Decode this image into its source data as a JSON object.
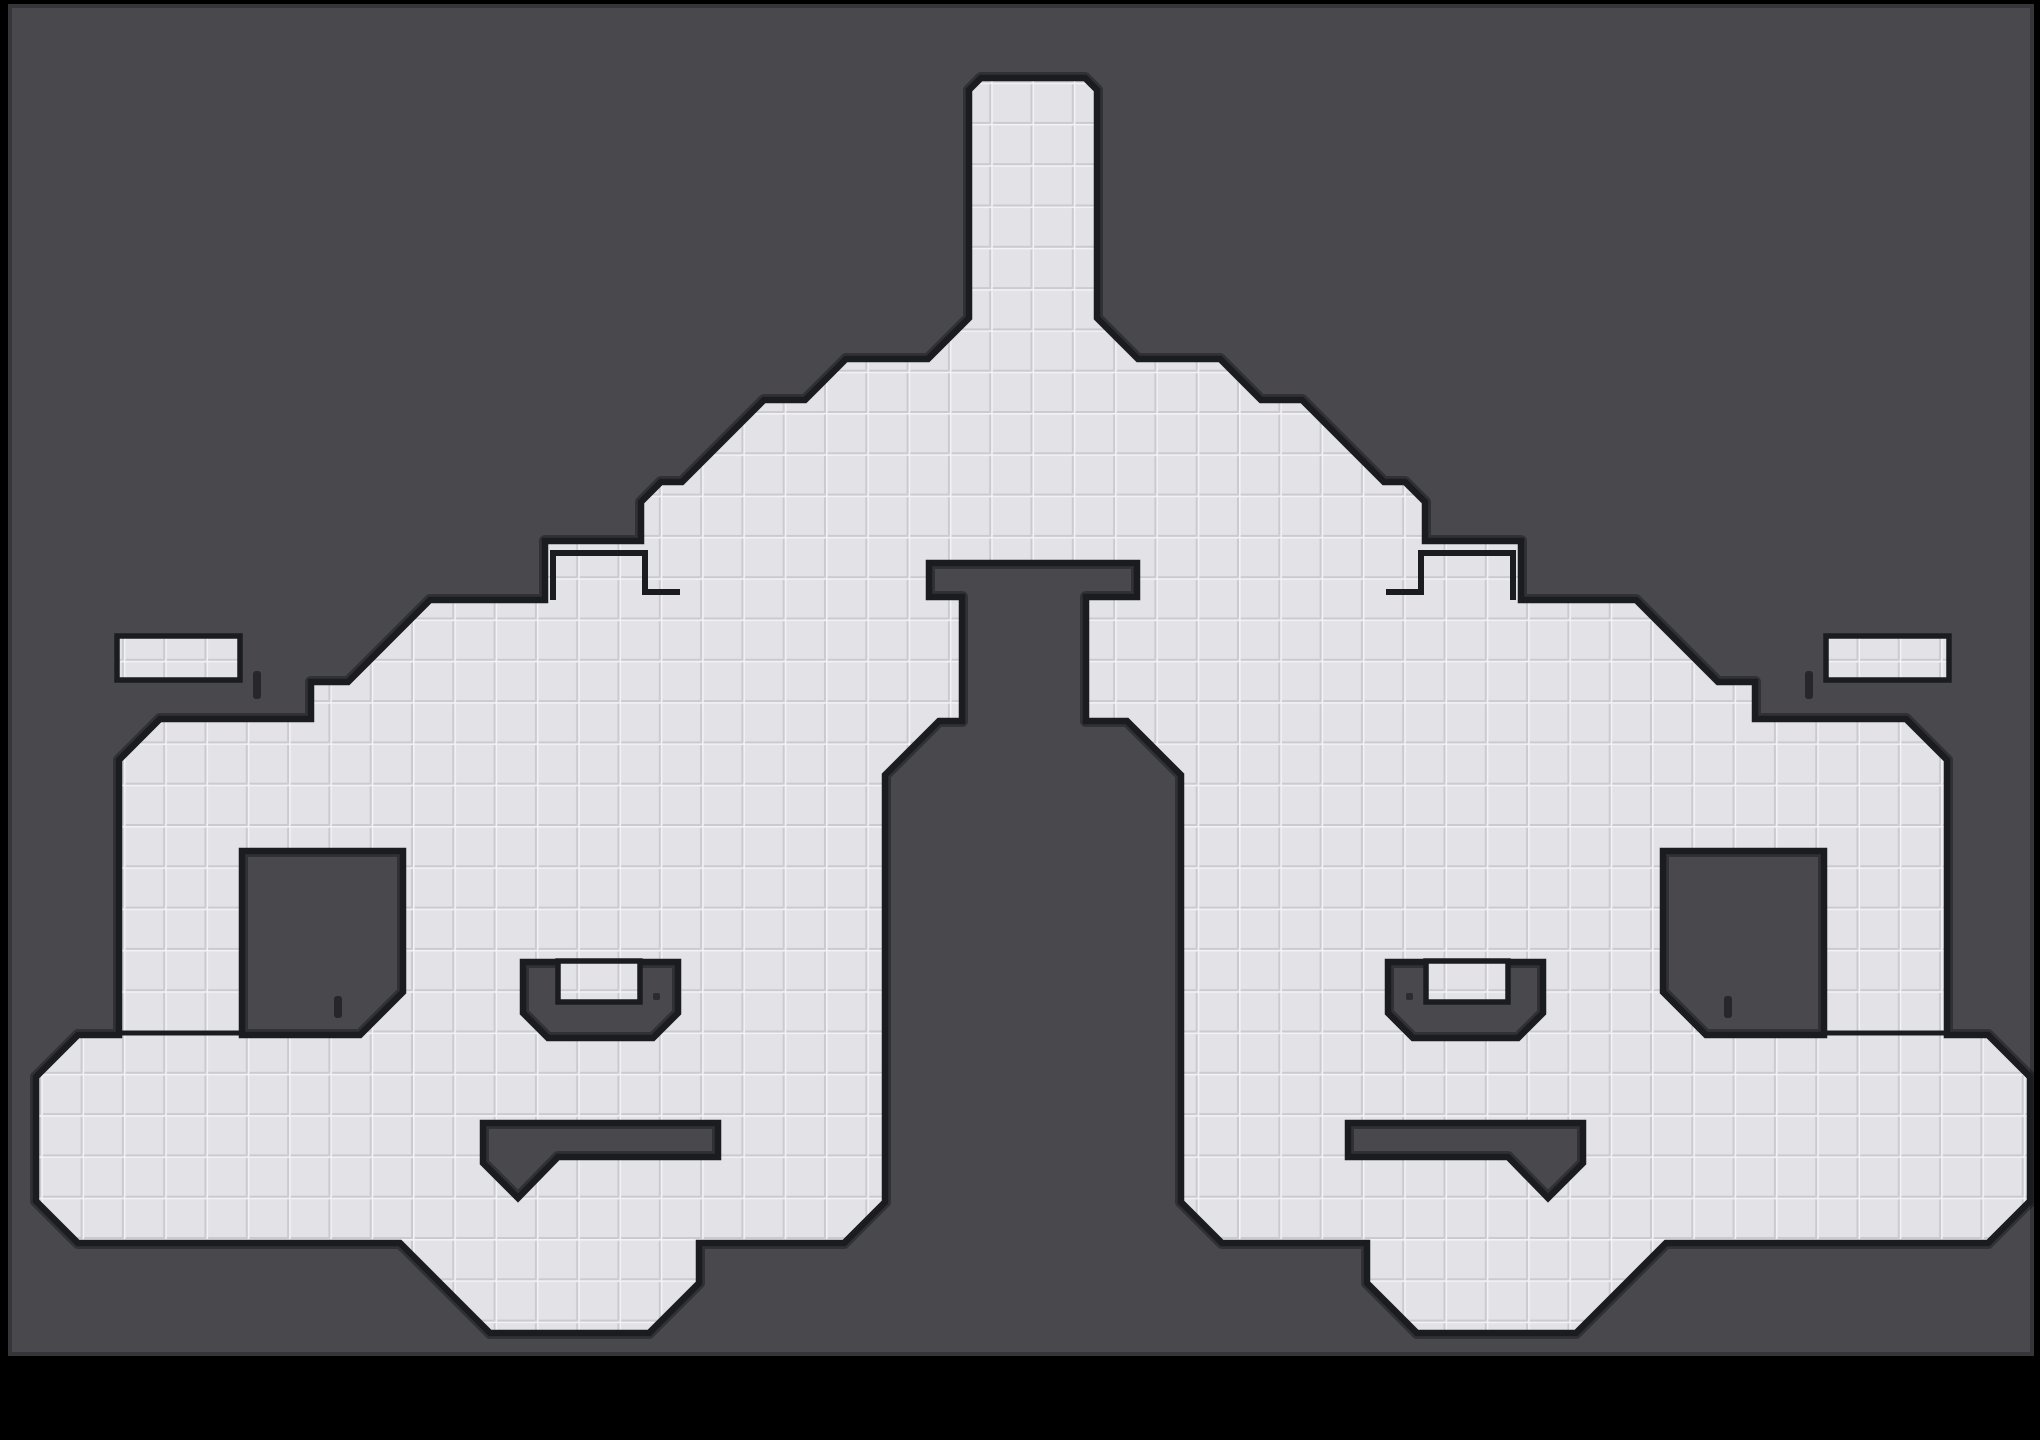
{
  "scene": {
    "kind": "tile-platformer-level-map",
    "canvas": {
      "w": 2040,
      "h": 1440
    },
    "field": {
      "x": 10,
      "y": 6,
      "w": 2022,
      "h": 1348
    }
  },
  "palette": {
    "page_bg": "#000000",
    "field_bg": "#49494d",
    "field_border": "#35353a",
    "tile": "#e3e3e7",
    "tile_line": "#cbcbcf",
    "tile_highlight": "#f2f2f6",
    "outline": "#1b1c20",
    "gold": "#f6c41c",
    "bomb_purple": "#bb7fb6",
    "green_block": "#9ed45e",
    "dotted_block": "#a0a0a4",
    "cross_orange": "#e85f2e",
    "cross_yellow": "#eda211",
    "cross_teal": "#45a89e",
    "flag_red": "#e8402e",
    "flag_red_tip": "#f5a02c",
    "flag_teal": "#4fa8cc",
    "flag_teal_tip": "#6ec98e",
    "gear": "#1a1a1a",
    "orb_green": "#8fce62"
  },
  "geometry": {
    "tile_size": 41.3,
    "outline": [
      [
        981,
        78
      ],
      [
        1085,
        78
      ],
      [
        1097,
        90
      ],
      [
        1097,
        318
      ],
      [
        1138,
        359
      ],
      [
        1220,
        359
      ],
      [
        1261,
        400
      ],
      [
        1302,
        400
      ],
      [
        1384,
        482
      ],
      [
        1405,
        482
      ],
      [
        1425,
        502
      ],
      [
        1425,
        541
      ],
      [
        1521,
        541
      ],
      [
        1521,
        600
      ],
      [
        1636,
        600
      ],
      [
        1718,
        682
      ],
      [
        1755,
        682
      ],
      [
        1755,
        719
      ],
      [
        1906,
        719
      ],
      [
        1947,
        760
      ],
      [
        1947,
        1035
      ],
      [
        1988,
        1035
      ],
      [
        2030,
        1077
      ],
      [
        2030,
        1201
      ],
      [
        1988,
        1243
      ],
      [
        1666,
        1243
      ],
      [
        1626,
        1283
      ],
      [
        1576,
        1333
      ],
      [
        1417,
        1333
      ],
      [
        1367,
        1283
      ],
      [
        1367,
        1243
      ],
      [
        1222,
        1243
      ],
      [
        1181,
        1202
      ],
      [
        1181,
        775
      ],
      [
        1127,
        721
      ],
      [
        1086,
        721
      ],
      [
        1086,
        597
      ],
      [
        1137,
        597
      ],
      [
        1137,
        563
      ],
      [
        929,
        563
      ],
      [
        929,
        597
      ],
      [
        962,
        597
      ],
      [
        962,
        721
      ],
      [
        939,
        721
      ],
      [
        885,
        775
      ],
      [
        885,
        1202
      ],
      [
        844,
        1243
      ],
      [
        699,
        1243
      ],
      [
        699,
        1283
      ],
      [
        649,
        1333
      ],
      [
        490,
        1333
      ],
      [
        440,
        1283
      ],
      [
        400,
        1243
      ],
      [
        78,
        1243
      ],
      [
        36,
        1201
      ],
      [
        36,
        1077
      ],
      [
        78,
        1035
      ],
      [
        119,
        1035
      ],
      [
        119,
        760
      ],
      [
        160,
        719
      ],
      [
        311,
        719
      ],
      [
        311,
        682
      ],
      [
        348,
        682
      ],
      [
        430,
        600
      ],
      [
        545,
        600
      ],
      [
        545,
        541
      ],
      [
        641,
        541
      ],
      [
        641,
        502
      ],
      [
        661,
        482
      ],
      [
        682,
        482
      ],
      [
        764,
        400
      ],
      [
        805,
        400
      ],
      [
        846,
        359
      ],
      [
        928,
        359
      ],
      [
        969,
        318
      ],
      [
        969,
        90
      ]
    ],
    "holes": [
      [
        [
          242,
          851
        ],
        [
          403,
          851
        ],
        [
          403,
          992
        ],
        [
          360,
          1035
        ],
        [
          242,
          1035
        ]
      ],
      [
        [
          1663,
          851
        ],
        [
          1824,
          851
        ],
        [
          1824,
          1035
        ],
        [
          1706,
          1035
        ],
        [
          1663,
          992
        ]
      ],
      [
        [
          523,
          962
        ],
        [
          678,
          962
        ],
        [
          678,
          1013
        ],
        [
          653,
          1038
        ],
        [
          548,
          1038
        ],
        [
          523,
          1013
        ]
      ],
      [
        [
          1388,
          962
        ],
        [
          1543,
          962
        ],
        [
          1543,
          1013
        ],
        [
          1518,
          1038
        ],
        [
          1413,
          1038
        ],
        [
          1388,
          1013
        ]
      ],
      [
        [
          483,
          1123
        ],
        [
          718,
          1123
        ],
        [
          718,
          1157
        ],
        [
          558,
          1157
        ],
        [
          518,
          1198
        ],
        [
          483,
          1163
        ]
      ],
      [
        [
          1348,
          1123
        ],
        [
          1583,
          1123
        ],
        [
          1583,
          1163
        ],
        [
          1548,
          1198
        ],
        [
          1508,
          1157
        ],
        [
          1348,
          1157
        ]
      ]
    ],
    "notch_lines": [
      [
        [
          553,
          600
        ],
        [
          553,
          553
        ],
        [
          645,
          553
        ],
        [
          645,
          592
        ],
        [
          680,
          592
        ]
      ],
      [
        [
          1513,
          600
        ],
        [
          1513,
          553
        ],
        [
          1421,
          553
        ],
        [
          1421,
          592
        ],
        [
          1386,
          592
        ]
      ]
    ],
    "seam_lines": [
      [
        [
          117,
          1033
        ],
        [
          244,
          1033
        ]
      ],
      [
        [
          1822,
          1033
        ],
        [
          1949,
          1033
        ]
      ]
    ],
    "platforms": [
      {
        "x": 117,
        "y": 636,
        "w": 123,
        "h": 44
      },
      {
        "x": 1826,
        "y": 636,
        "w": 123,
        "h": 44
      },
      {
        "x": 558,
        "y": 961,
        "w": 82,
        "h": 41
      },
      {
        "x": 1426,
        "y": 961,
        "w": 82,
        "h": 41
      }
    ],
    "door_ticks": [
      {
        "x": 253,
        "y": 671,
        "w": 8,
        "h": 28
      },
      {
        "x": 1805,
        "y": 671,
        "w": 8,
        "h": 28
      },
      {
        "x": 334,
        "y": 996,
        "w": 8,
        "h": 22
      },
      {
        "x": 1724,
        "y": 996,
        "w": 8,
        "h": 22
      }
    ],
    "small_dots": [
      {
        "x": 653,
        "y": 993,
        "w": 7,
        "h": 7
      },
      {
        "x": 1406,
        "y": 993,
        "w": 7,
        "h": 7
      }
    ]
  },
  "objects": {
    "bombs": [
      [
        139,
        659
      ],
      [
        178,
        659
      ],
      [
        217,
        659
      ],
      [
        1849,
        659
      ],
      [
        1888,
        659
      ],
      [
        1927,
        659
      ],
      [
        579,
        981
      ],
      [
        621,
        981
      ],
      [
        1445,
        981
      ],
      [
        1487,
        981
      ]
    ],
    "coins": [
      [
        182,
        789
      ],
      [
        871,
        669
      ],
      [
        829,
        952
      ],
      [
        829,
        1076
      ],
      [
        578,
        1180
      ],
      [
        1884,
        789
      ],
      [
        1195,
        669
      ],
      [
        1237,
        952
      ],
      [
        1237,
        1076
      ],
      [
        1488,
        1180
      ]
    ],
    "gears": [
      [
        818,
        501
      ],
      [
        1248,
        501
      ],
      [
        580,
        579
      ],
      [
        620,
        579
      ],
      [
        1446,
        579
      ],
      [
        1486,
        579
      ]
    ],
    "crosses": [
      {
        "x": 709,
        "y": 750,
        "color": "yellow"
      },
      {
        "x": 746,
        "y": 792,
        "color": "yellow"
      },
      {
        "x": 790,
        "y": 1181,
        "color": "yellow"
      },
      {
        "x": 1357,
        "y": 750,
        "color": "yellow"
      },
      {
        "x": 1320,
        "y": 792,
        "color": "yellow"
      },
      {
        "x": 1276,
        "y": 1181,
        "color": "yellow"
      },
      {
        "x": 419,
        "y": 980,
        "color": "orange"
      },
      {
        "x": 458,
        "y": 980,
        "color": "orange"
      },
      {
        "x": 498,
        "y": 980,
        "color": "orange"
      },
      {
        "x": 1538,
        "y": 980,
        "color": "teal"
      },
      {
        "x": 1579,
        "y": 980,
        "color": "teal"
      },
      {
        "x": 1619,
        "y": 980,
        "color": "teal"
      }
    ],
    "green_single_blocks": [
      {
        "x": 275,
        "y": 963,
        "size": 38
      },
      {
        "x": 1753,
        "y": 963,
        "size": 38
      }
    ],
    "green_bridge": {
      "cols": [
        890,
        931,
        972,
        1013,
        1054,
        1095,
        1136
      ],
      "rows": [
        958,
        999
      ],
      "size": 38
    },
    "dotted_grid": {
      "x": 963,
      "y": 601,
      "cols": 3,
      "rows": 3,
      "step": 41,
      "size": 39
    },
    "orb": {
      "x": 1034,
      "y": 466
    },
    "flags": [
      {
        "x": 162,
        "y": 1160,
        "variant": "red"
      },
      {
        "x": 1843,
        "y": 1160,
        "variant": "teal"
      }
    ]
  }
}
